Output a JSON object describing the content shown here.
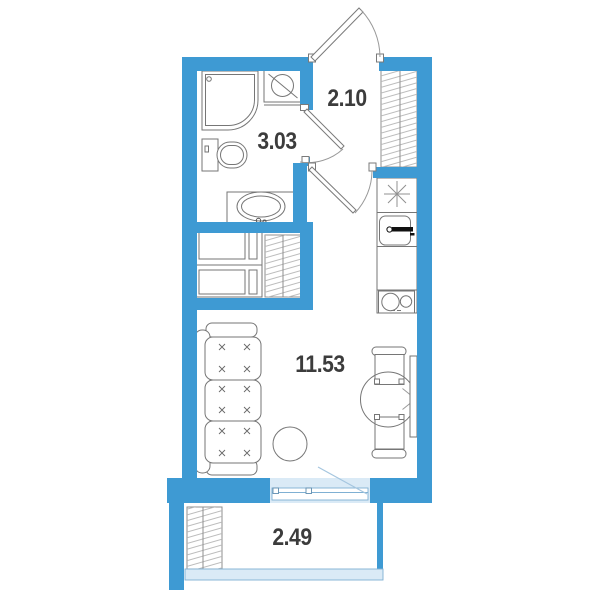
{
  "plan": {
    "rooms": {
      "hallway": {
        "area_label": "2.10"
      },
      "bathroom": {
        "area_label": "3.03"
      },
      "living_room": {
        "area_label": "11.53"
      },
      "balcony": {
        "area_label": "2.49"
      }
    },
    "colors": {
      "wall": "#3e9ad3",
      "glazing_fill": "#daeaf6",
      "glazing_stroke": "#7fb0d3",
      "furniture_line": "#767676",
      "hatch_line": "#b5b5b5",
      "door_swing_line": "#a5c6df",
      "label_text": "#3c3c3c"
    },
    "fixtures": [
      "entrance-door",
      "shower",
      "washing-machine",
      "toilet",
      "bathroom-sink",
      "wardrobe",
      "vent-shaft",
      "cooktop",
      "kitchen-sink",
      "stove",
      "kitchen-counter",
      "sofa",
      "stool",
      "dining-table",
      "chair",
      "radiator",
      "balcony-door",
      "balcony-glazing"
    ]
  }
}
